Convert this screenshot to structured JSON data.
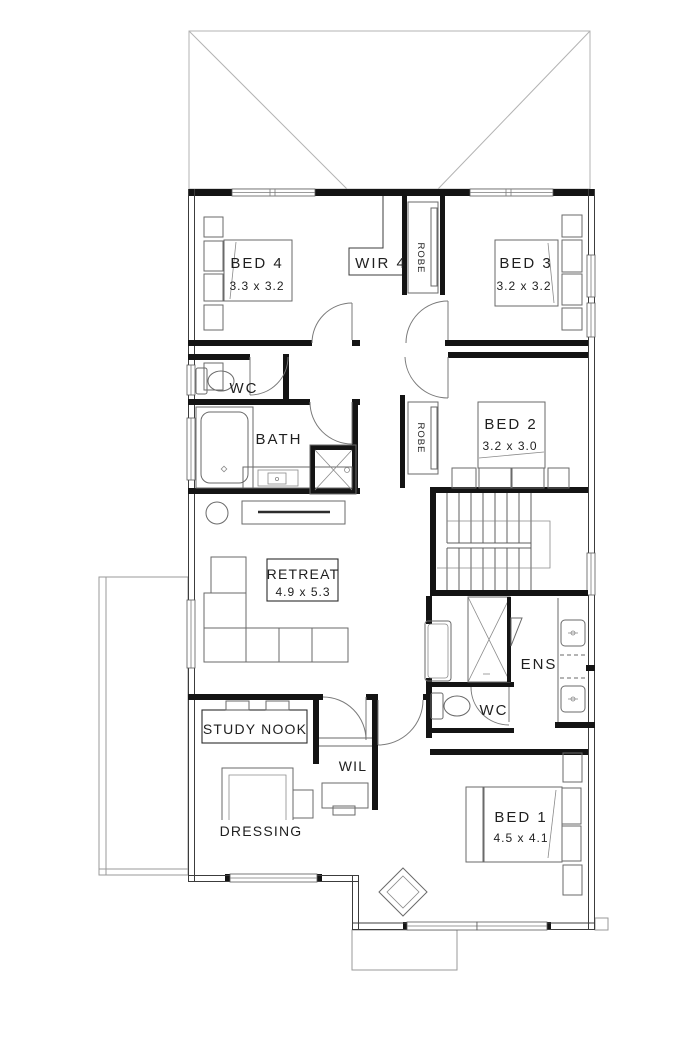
{
  "plan": {
    "title": "upper-floor-plan",
    "rooms": {
      "bed4": {
        "name": "BED 4",
        "dims": "3.3 x 3.2"
      },
      "wir4": {
        "name": "WIR 4"
      },
      "robe_bed3": {
        "name": "ROBE"
      },
      "bed3": {
        "name": "BED 3",
        "dims": "3.2 x 3.2"
      },
      "wc_upper": {
        "name": "WC"
      },
      "bath": {
        "name": "BATH"
      },
      "robe_bed2": {
        "name": "ROBE"
      },
      "bed2": {
        "name": "BED 2",
        "dims": "3.2 x 3.0"
      },
      "retreat": {
        "name": "RETREAT",
        "dims": "4.9 x 5.3"
      },
      "ens": {
        "name": "ENS"
      },
      "wc_ens": {
        "name": "WC"
      },
      "study_nook": {
        "name": "STUDY NOOK"
      },
      "wil": {
        "name": "WIL"
      },
      "dressing": {
        "name": "DRESSING"
      },
      "bed1": {
        "name": "BED 1",
        "dims": "4.5 x 4.1"
      }
    },
    "symbols": {
      "bed": "double-bed-symbol",
      "toilet": "toilet-symbol",
      "bathtub": "bathtub-symbol",
      "shower": "shower-symbol",
      "vanity": "vanity-basin-symbol",
      "sofa": "l-shaped-sofa-symbol",
      "stairs": "u-return-stair-symbol",
      "roof": "hip-roof-outline"
    },
    "colors": {
      "wall": "#141414",
      "line": "#555555",
      "roof": "#b3b3b3",
      "background": "#ffffff"
    }
  }
}
